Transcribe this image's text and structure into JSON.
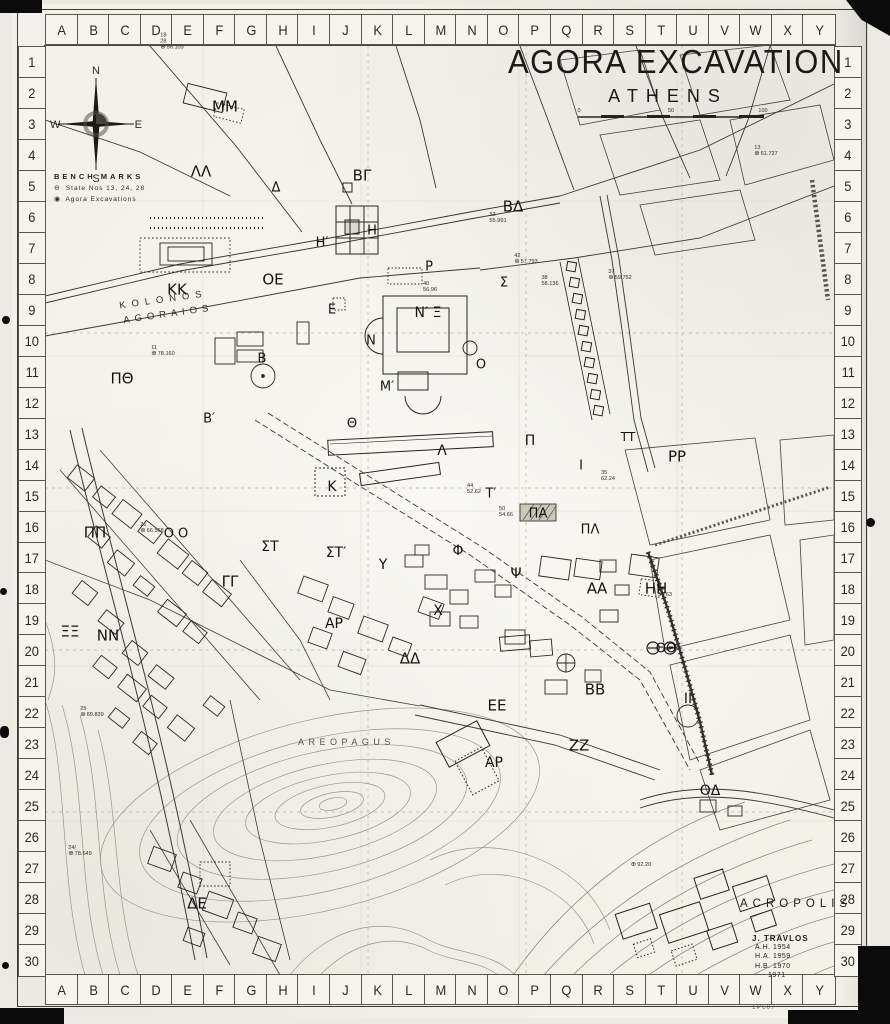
{
  "meta": {
    "title": "AGORA EXCAVATION",
    "subtitle": "ATHENS",
    "sheet_number": "1P607"
  },
  "colors": {
    "paper": "#f3f1ea",
    "ink": "#1b1a17",
    "faint_ink": "#8f8b7e",
    "photo_edge": "#0b0b0b"
  },
  "grid": {
    "columns": [
      "A",
      "B",
      "C",
      "D",
      "E",
      "F",
      "G",
      "H",
      "I",
      "J",
      "K",
      "L",
      "M",
      "N",
      "O",
      "P",
      "Q",
      "R",
      "S",
      "T",
      "U",
      "V",
      "W",
      "X",
      "Y"
    ],
    "rows": [
      "1",
      "2",
      "3",
      "4",
      "5",
      "6",
      "7",
      "8",
      "9",
      "10",
      "11",
      "12",
      "13",
      "14",
      "15",
      "16",
      "17",
      "18",
      "19",
      "20",
      "21",
      "22",
      "23",
      "24",
      "25",
      "26",
      "27",
      "28",
      "29",
      "30"
    ]
  },
  "compass": {
    "north": "N",
    "east": "E",
    "south": "S",
    "west": "W"
  },
  "legend": {
    "title": "BENCH MARKS",
    "items": [
      {
        "symbol": "⊖",
        "label": "State  Nos  13, 24, 28"
      },
      {
        "symbol": "◉",
        "label": "Agora  Excavations"
      }
    ]
  },
  "scale_bar": {
    "ticks": [
      "0",
      "50",
      "100"
    ]
  },
  "place_names": {
    "kolonos_line1": "KOLONOS",
    "kolonos_line2": "AGORAIOS",
    "areopagus": "AREOPAGUS",
    "acropolis": "ACROPOLIS"
  },
  "credits": {
    "name": "J. TRAVLOS",
    "lines": [
      "A.H.  1954",
      "H.A.  1959",
      "H.B.  1970",
      "1971"
    ]
  },
  "map_labels": [
    {
      "t": "ΜΜ",
      "x": 225,
      "y": 107,
      "s": 15
    },
    {
      "t": "ΛΛ",
      "x": 201,
      "y": 172,
      "s": 15
    },
    {
      "t": "Δ",
      "x": 276,
      "y": 188,
      "s": 13
    },
    {
      "t": "ΒΓ",
      "x": 362,
      "y": 176,
      "s": 15
    },
    {
      "t": "ΒΔ",
      "x": 513,
      "y": 207,
      "s": 15
    },
    {
      "t": "Η′",
      "x": 322,
      "y": 243,
      "s": 13
    },
    {
      "t": "Η",
      "x": 372,
      "y": 231,
      "s": 13
    },
    {
      "t": "Ρ",
      "x": 429,
      "y": 267,
      "s": 13
    },
    {
      "t": "Σ",
      "x": 504,
      "y": 283,
      "s": 13
    },
    {
      "t": "ΚΚ",
      "x": 177,
      "y": 290,
      "s": 15
    },
    {
      "t": "ΟΕ",
      "x": 273,
      "y": 280,
      "s": 15
    },
    {
      "t": "Ε",
      "x": 332,
      "y": 310,
      "s": 13
    },
    {
      "t": "Ν′ Ξ",
      "x": 428,
      "y": 313,
      "s": 14
    },
    {
      "t": "Ν",
      "x": 371,
      "y": 341,
      "s": 13
    },
    {
      "t": "Ο",
      "x": 481,
      "y": 365,
      "s": 13
    },
    {
      "t": "Μ′",
      "x": 387,
      "y": 387,
      "s": 13
    },
    {
      "t": "ΠΘ",
      "x": 122,
      "y": 379,
      "s": 15
    },
    {
      "t": "Β′",
      "x": 209,
      "y": 419,
      "s": 13
    },
    {
      "t": "Β",
      "x": 262,
      "y": 359,
      "s": 13
    },
    {
      "t": "Θ",
      "x": 352,
      "y": 424,
      "s": 13
    },
    {
      "t": "Λ",
      "x": 442,
      "y": 451,
      "s": 14
    },
    {
      "t": "Κ",
      "x": 332,
      "y": 487,
      "s": 14
    },
    {
      "t": "Π",
      "x": 530,
      "y": 441,
      "s": 14
    },
    {
      "t": "Ι",
      "x": 581,
      "y": 466,
      "s": 13
    },
    {
      "t": "Τ′",
      "x": 491,
      "y": 494,
      "s": 13
    },
    {
      "t": "ΠΑ",
      "x": 538,
      "y": 514,
      "s": 13
    },
    {
      "t": "ΠΛ",
      "x": 590,
      "y": 530,
      "s": 13
    },
    {
      "t": "ΤΤ",
      "x": 628,
      "y": 437,
      "s": 12
    },
    {
      "t": "ΡΡ",
      "x": 677,
      "y": 457,
      "s": 15
    },
    {
      "t": "ΠΠ",
      "x": 95,
      "y": 533,
      "s": 15
    },
    {
      "t": "Ο Ο",
      "x": 176,
      "y": 534,
      "s": 13
    },
    {
      "t": "ΣΤ",
      "x": 270,
      "y": 547,
      "s": 14
    },
    {
      "t": "ΣΤ′",
      "x": 336,
      "y": 553,
      "s": 14
    },
    {
      "t": "Υ",
      "x": 383,
      "y": 565,
      "s": 14
    },
    {
      "t": "ΓΓ",
      "x": 230,
      "y": 582,
      "s": 15
    },
    {
      "t": "Φ",
      "x": 458,
      "y": 551,
      "s": 14
    },
    {
      "t": "Ψ",
      "x": 516,
      "y": 574,
      "s": 14
    },
    {
      "t": "Χ",
      "x": 438,
      "y": 611,
      "s": 14
    },
    {
      "t": "ΑΑ",
      "x": 597,
      "y": 589,
      "s": 15
    },
    {
      "t": "ΗΗ",
      "x": 656,
      "y": 589,
      "s": 15
    },
    {
      "t": "ΞΞ",
      "x": 70,
      "y": 632,
      "s": 15
    },
    {
      "t": "ΝΝ",
      "x": 108,
      "y": 636,
      "s": 15
    },
    {
      "t": "ΑΡ",
      "x": 334,
      "y": 624,
      "s": 14
    },
    {
      "t": "ΔΔ",
      "x": 410,
      "y": 659,
      "s": 15
    },
    {
      "t": "ΘΘ",
      "x": 666,
      "y": 649,
      "s": 13
    },
    {
      "t": "ΒΒ",
      "x": 595,
      "y": 690,
      "s": 15
    },
    {
      "t": "ΙΙ",
      "x": 688,
      "y": 699,
      "s": 14
    },
    {
      "t": "ΕΕ",
      "x": 497,
      "y": 706,
      "s": 15
    },
    {
      "t": "ΖΖ",
      "x": 579,
      "y": 746,
      "s": 15
    },
    {
      "t": "ΑΡ",
      "x": 494,
      "y": 763,
      "s": 14
    },
    {
      "t": "ΟΔ",
      "x": 710,
      "y": 791,
      "s": 14
    },
    {
      "t": "ΔΕ",
      "x": 197,
      "y": 904,
      "s": 15
    }
  ],
  "bench_marks": [
    {
      "sym": "⊕",
      "lines": [
        "18",
        "28",
        "56.103"
      ],
      "x": 172,
      "y": 42
    },
    {
      "sym": "⊕",
      "lines": [
        "13",
        "61.727"
      ],
      "x": 766,
      "y": 151
    },
    {
      "sym": "⊕",
      "lines": [
        "11",
        "78.160"
      ],
      "x": 163,
      "y": 351
    },
    {
      "sym": "⊕",
      "lines": [
        "24/",
        "78.649"
      ],
      "x": 80,
      "y": 851
    },
    {
      "sym": "",
      "lines": [
        "40",
        "56.96"
      ],
      "x": 430,
      "y": 287
    },
    {
      "sym": "",
      "lines": [
        "52",
        "55.991"
      ],
      "x": 498,
      "y": 218
    },
    {
      "sym": "⊛",
      "lines": [
        "42",
        "57.793"
      ],
      "x": 526,
      "y": 259
    },
    {
      "sym": "",
      "lines": [
        "38",
        "58.136"
      ],
      "x": 550,
      "y": 281
    },
    {
      "sym": "⊛",
      "lines": [
        "37",
        "59.752"
      ],
      "x": 620,
      "y": 275
    },
    {
      "sym": "",
      "lines": [
        "35",
        "62.24"
      ],
      "x": 608,
      "y": 476
    },
    {
      "sym": "",
      "lines": [
        "44",
        "52.62"
      ],
      "x": 474,
      "y": 489
    },
    {
      "sym": "",
      "lines": [
        "50",
        "54.66"
      ],
      "x": 506,
      "y": 512
    },
    {
      "sym": "⊛",
      "lines": [
        "21",
        "66.568"
      ],
      "x": 152,
      "y": 528
    },
    {
      "sym": "",
      "lines": [
        "30",
        "56.63"
      ],
      "x": 665,
      "y": 592
    },
    {
      "sym": "⊛",
      "lines": [
        "25",
        "69.839"
      ],
      "x": 92,
      "y": 712
    },
    {
      "sym": "⊕",
      "lines": [
        "92.20"
      ],
      "x": 641,
      "y": 865
    }
  ]
}
